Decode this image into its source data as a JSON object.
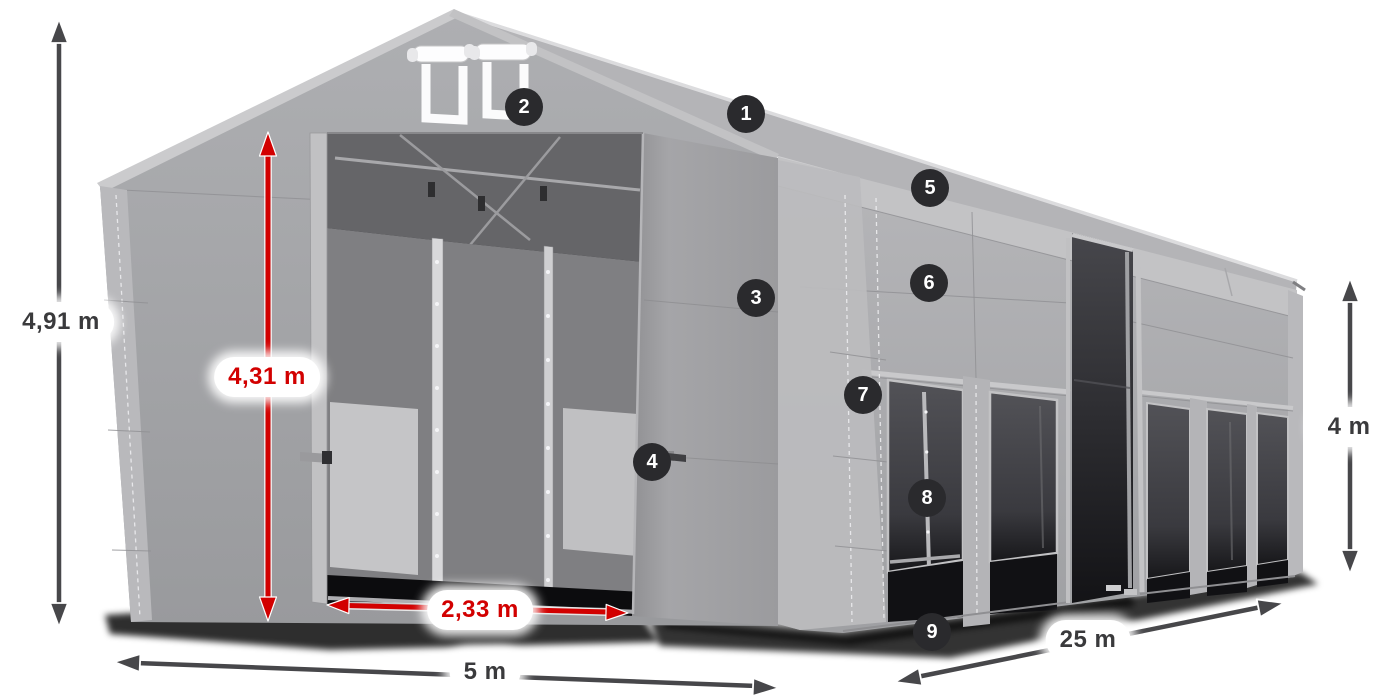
{
  "diagram": {
    "callouts": [
      {
        "number": "1"
      },
      {
        "number": "2"
      },
      {
        "number": "3"
      },
      {
        "number": "4"
      },
      {
        "number": "5"
      },
      {
        "number": "6"
      },
      {
        "number": "7"
      },
      {
        "number": "8"
      },
      {
        "number": "9"
      }
    ],
    "dimensions": {
      "total_height": "4,91 m",
      "inner_height": "4,31 m",
      "entrance_width": "2,33 m",
      "width": "5 m",
      "length": "25 m",
      "side_height": "4 m"
    },
    "colors": {
      "accent_red": "#d20000",
      "arrow_gray": "#47474a",
      "badge_bg": "#2a2a2d",
      "badge_text": "#ffffff",
      "label_text": "#3a3a3c",
      "pill_bg": "#ffffff"
    }
  }
}
